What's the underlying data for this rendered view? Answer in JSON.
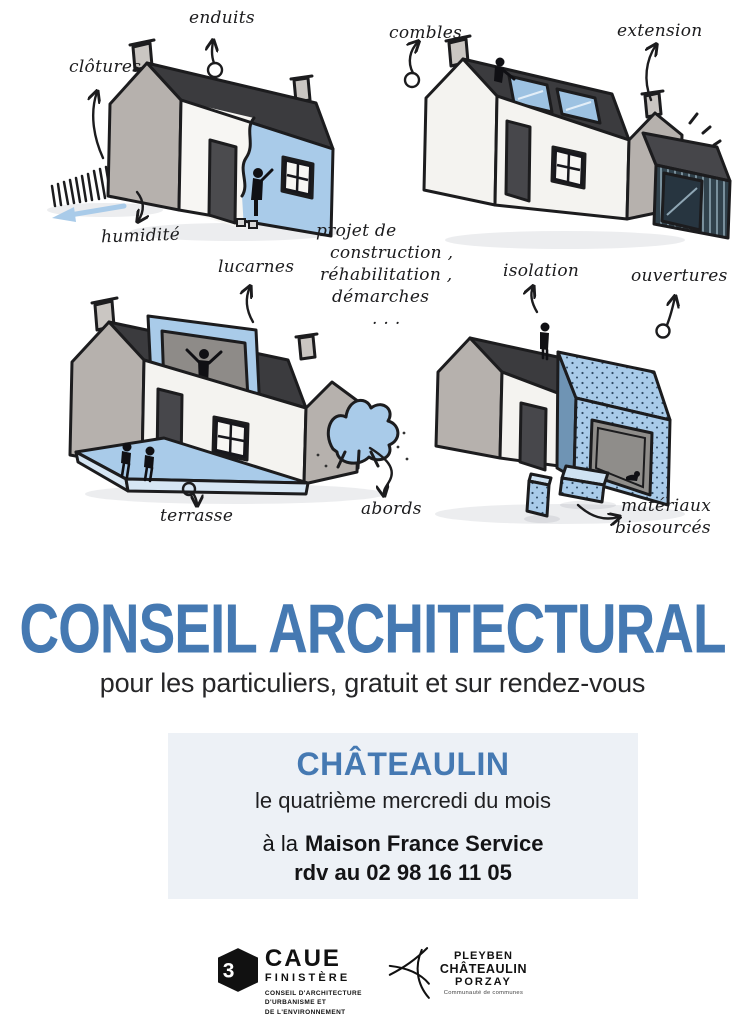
{
  "poster": {
    "title": "CONSEIL ARCHITECTURAL",
    "subtitle": "pour les particuliers, gratuit et sur rendez-vous"
  },
  "annotations": {
    "enduits": "enduits",
    "clotures": "clôtures",
    "humidite": "humidité",
    "combles": "combles",
    "extension": "extension",
    "lucarnes": "lucarnes",
    "terrasse": "terrasse",
    "abords": "abords",
    "isolation": "isolation",
    "ouvertures": "ouvertures",
    "materiaux_line1": "matériaux",
    "materiaux_line2": "biosourcés",
    "note_lines": [
      "projet de",
      "construction ,",
      "réhabilitation ,",
      "démarches",
      ". . ."
    ]
  },
  "info_box": {
    "city": "CHÂTEAULIN",
    "schedule": "le quatrième mercredi du mois",
    "location_prefix": "à la",
    "location_name": "Maison France Service",
    "phone": "rdv au 02 98 16 11 05"
  },
  "footer": {
    "caue": {
      "cube_glyph": "3",
      "acronym": "CAUE",
      "region": "FINISTÈRE",
      "lines": [
        "CONSEIL D'ARCHITECTURE",
        "D'URBANISME ET",
        "DE L'ENVIRONNEMENT"
      ]
    },
    "community": {
      "name_lines": [
        "PLEYBEN",
        "CHÂTEAULIN",
        "PORZAY"
      ],
      "tagline": "Communauté de communes"
    }
  },
  "colors": {
    "title_blue": "#4579b2",
    "accent_blue": "#a9cbe9",
    "roof_dark": "#3b3b3e",
    "box_bg": "#edf1f6"
  }
}
